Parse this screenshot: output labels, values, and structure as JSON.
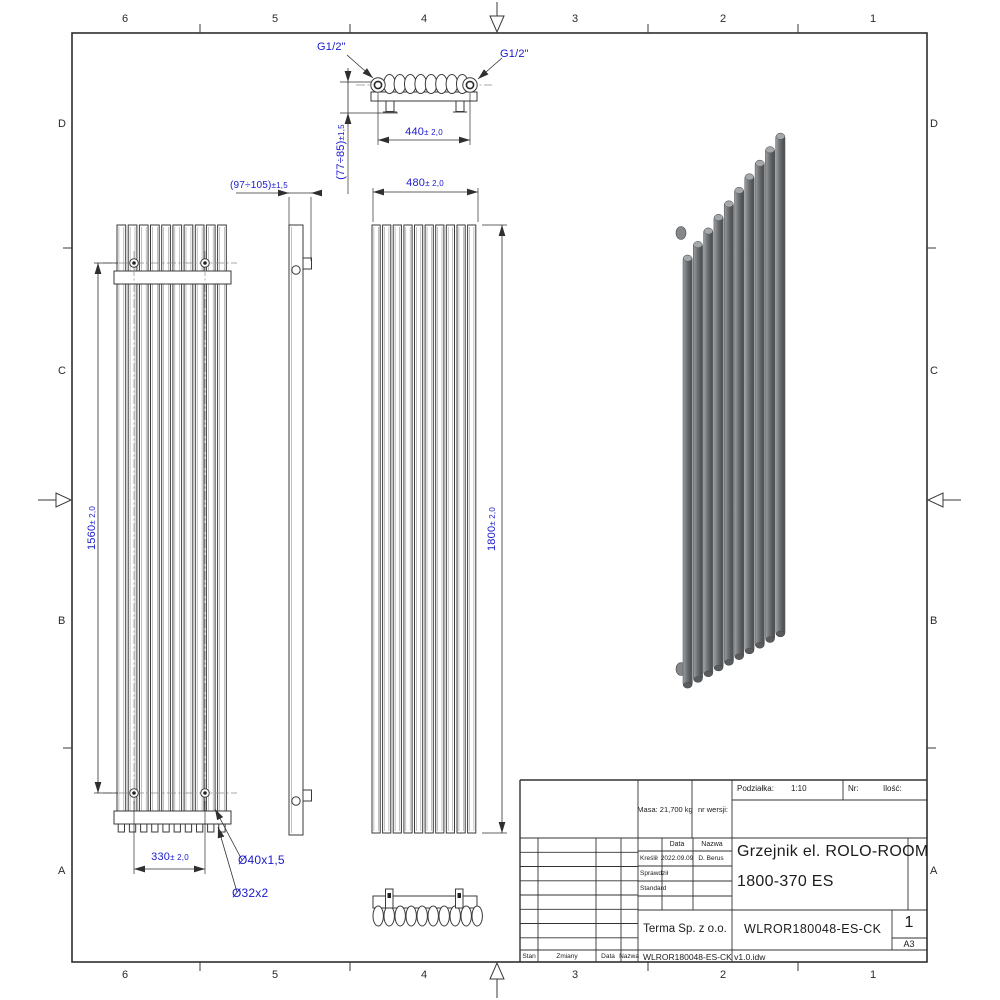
{
  "zones": {
    "columns": [
      "6",
      "5",
      "4",
      "3",
      "2",
      "1"
    ],
    "rows": [
      "D",
      "C",
      "B",
      "A"
    ]
  },
  "views": {
    "tube_count": 10,
    "top_oval_count": 8,
    "bottom_oval_count": 10
  },
  "dims": {
    "g12_left": "G1/2\"",
    "g12_right": "G1/2\"",
    "d440": {
      "v": "440",
      "t": "± 2,0"
    },
    "d77": {
      "v": "(77÷85)",
      "t": "±1,5"
    },
    "d97": {
      "v": "(97÷105)",
      "t": "±1,5"
    },
    "d480": {
      "v": "480",
      "t": "± 2,0"
    },
    "d1560": {
      "v": "1560",
      "t": "± 2,0"
    },
    "d1800": {
      "v": "1800",
      "t": "± 2,0"
    },
    "d330": {
      "v": "330",
      "t": "± 2,0"
    },
    "dia_tube": "Ø40x1,5",
    "dia_collector": "Ø32x2"
  },
  "title_block": {
    "scale_label": "Podziałka:",
    "scale_value": "1:10",
    "nr_label": "Nr:",
    "qty_label": "Ilość:",
    "mass": "Masa: 21,700 kg",
    "version_label": "nr wersji:",
    "col_date": "Data",
    "col_name": "Nazwa",
    "row_drawn": "Kreślił",
    "drawn_date": "2022.09.09",
    "drawn_by": "D. Berus",
    "row_checked": "Sprawdził",
    "row_standard": "Standard",
    "title_line1": "Grzejnik el. ROLO-ROOM",
    "title_line2": "1800-370 ES",
    "company": "Terma Sp. z o.o.",
    "part_number": "WLROR180048-ES-CK",
    "sheet_number": "1",
    "paper_size": "A3",
    "footer_stan": "Stan",
    "footer_zmiany": "Zmiany",
    "footer_data": "Data",
    "footer_nazwa": "Nazwa",
    "file_name": "WLROR180048-ES-CK v1.0.idw"
  },
  "colors": {
    "dimension_text": "#1a1acd",
    "line": "#2f2f2f",
    "tube_dark": "#55585a",
    "tube_light": "#9da0a2"
  }
}
